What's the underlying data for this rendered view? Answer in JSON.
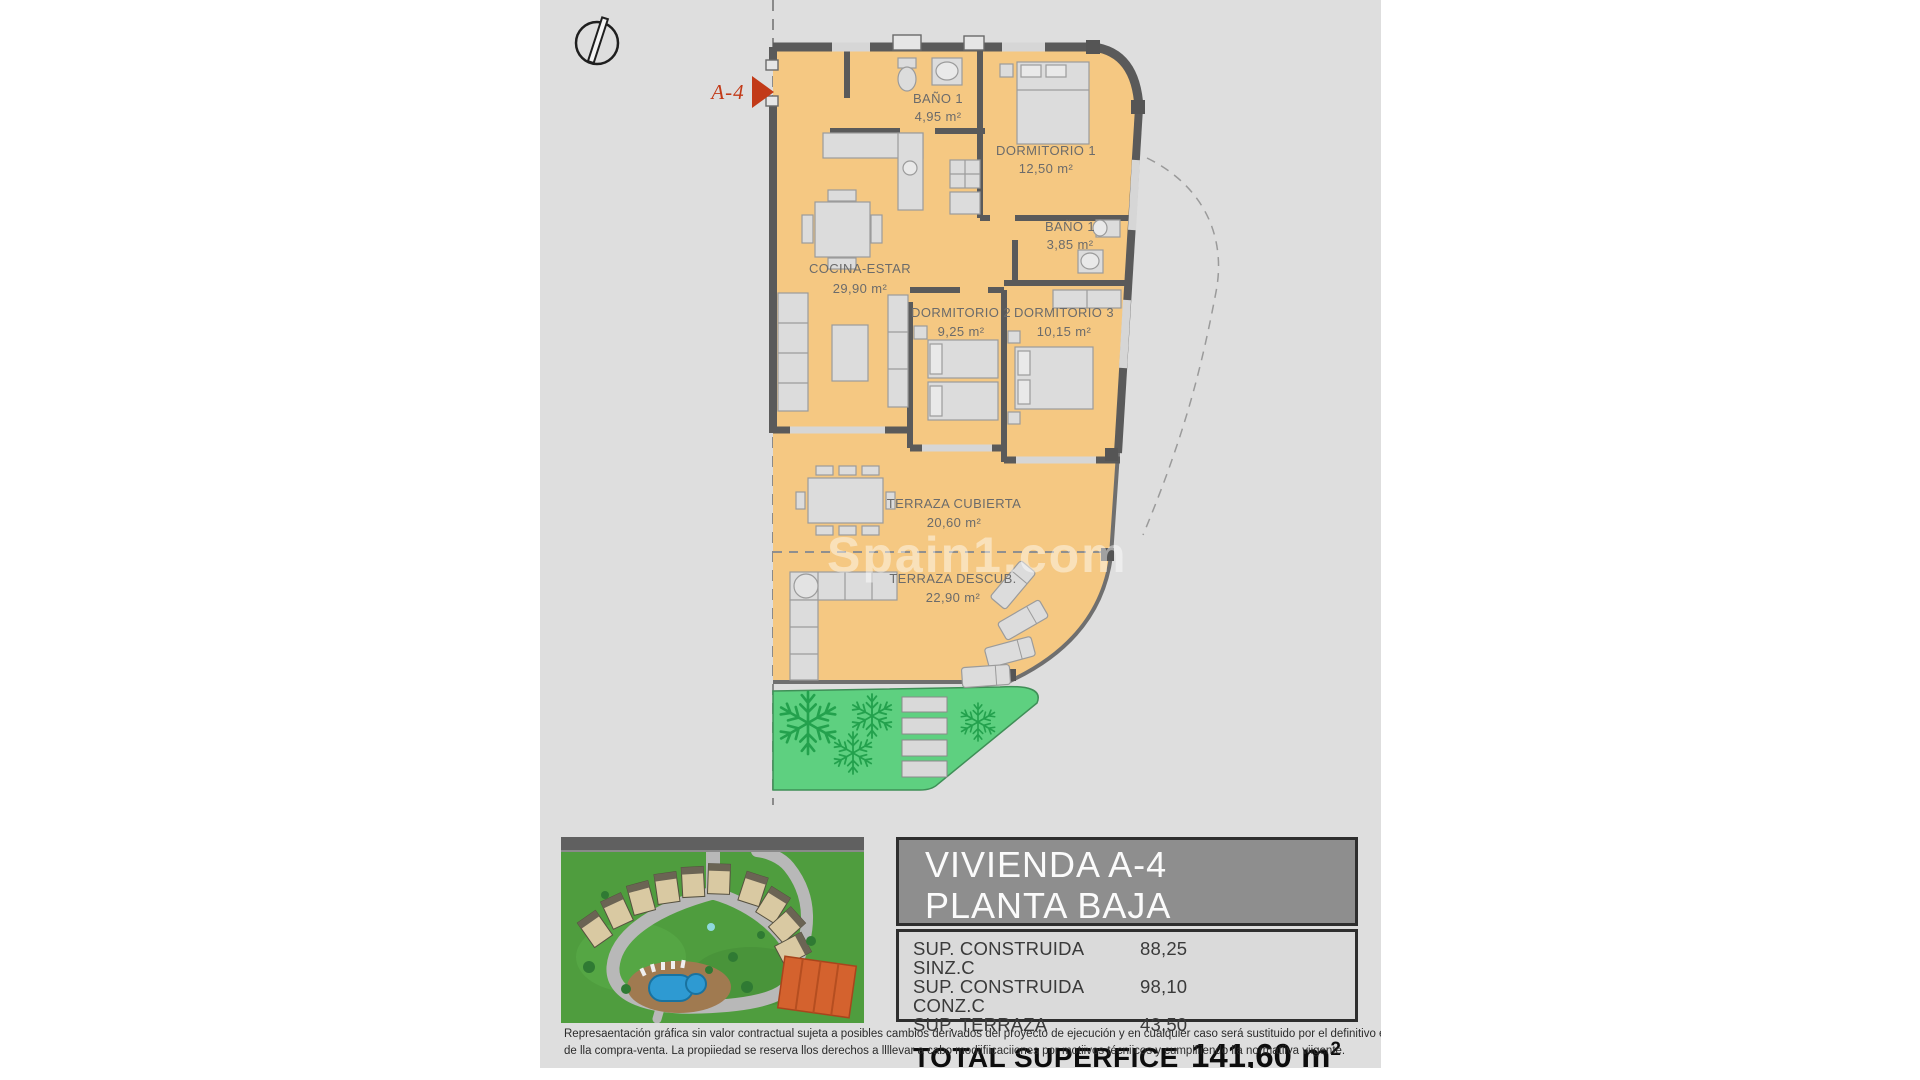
{
  "plan": {
    "compass": "north-indicator",
    "entry_marker": "A-4",
    "watermark": "Spain1.com",
    "rooms": [
      {
        "name": "BAÑO 1",
        "area": "4,95 m²"
      },
      {
        "name": "DORMITORIO 1",
        "area": "12,50 m²"
      },
      {
        "name": "BAÑO 1",
        "area": "3,85 m²"
      },
      {
        "name": "COCINA-ESTAR",
        "area": "29,90 m²"
      },
      {
        "name": "DORMITORIO 2",
        "area": "9,25 m²"
      },
      {
        "name": "DORMITORIO 3",
        "area": "10,15 m²"
      },
      {
        "name": "TERRAZA CUBIERTA",
        "area": "20,60 m²"
      },
      {
        "name": "TERRAZA DESCUB.",
        "area": "22,90 m²"
      }
    ]
  },
  "info_panel": {
    "title_line1": "VIVIENDA A-4",
    "title_line2": "PLANTA BAJA",
    "rows": [
      {
        "label": "SUP. CONSTRUIDA SINZ.C",
        "value": "88,25"
      },
      {
        "label": "SUP. CONSTRUIDA CONZ.C",
        "value": "98,10"
      },
      {
        "label": "SUP. TERRAZA",
        "value": "43,50"
      }
    ],
    "total_label": "TOTAL SUPERFICE",
    "total_value": "141,60 m",
    "total_value_sup": "2"
  },
  "disclaimer": {
    "line1": "Represaentación gráfica sin valor contractual sujeta a posibles cambios derivados del proyecto de ejecución y en cualquier caso será sustituido por el definitivo en",
    "line2": "de lla compra-venta. La propiiedad se reserva llos derechos a llllevar a cabo modiifiicaciiones por motiivos técniicos y cumplliiendo lla normatiiva viigente."
  },
  "colors": {
    "canvas": "#dedede",
    "floor": "#f5c882",
    "wall": "#5a5a5a",
    "grass": "#5ed080",
    "accent_red": "#c23a18",
    "highlight_unit": "#d4622e"
  }
}
